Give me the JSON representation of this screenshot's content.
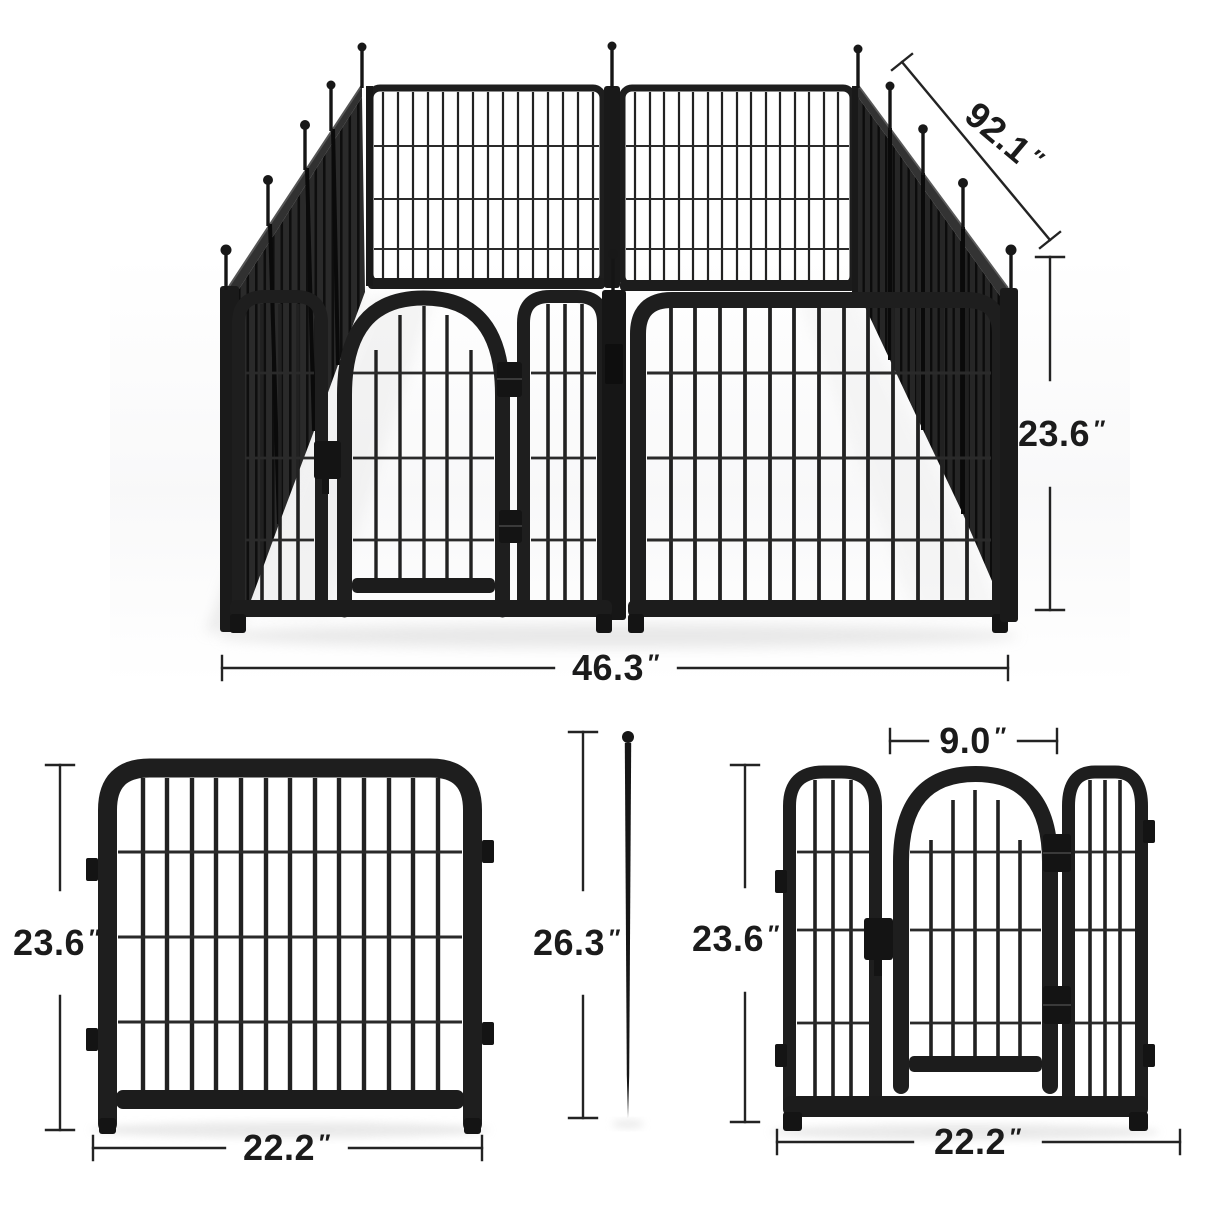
{
  "product": {
    "name": "Metal dog playpen dimension diagram",
    "views_count": "4"
  },
  "views": {
    "assembled_3d": {
      "name": "assembled-playpen-3d-view",
      "dims": {
        "depth": {
          "value": "92.1",
          "unit": "″"
        },
        "height": {
          "value": "23.6",
          "unit": "″"
        },
        "width": {
          "value": "46.3",
          "unit": "″"
        }
      }
    },
    "single_panel": {
      "name": "single-panel-front-view",
      "dims": {
        "height": {
          "value": "23.6",
          "unit": "″"
        },
        "width": {
          "value": "22.2",
          "unit": "″"
        }
      }
    },
    "ground_stake": {
      "name": "ground-stake-view",
      "dims": {
        "length": {
          "value": "26.3",
          "unit": "″"
        }
      }
    },
    "door_panel": {
      "name": "door-panel-front-view",
      "dims": {
        "door_width": {
          "value": "9.0",
          "unit": "″"
        },
        "height": {
          "value": "23.6",
          "unit": "″"
        },
        "width": {
          "value": "22.2",
          "unit": "″"
        }
      }
    }
  },
  "colors": {
    "metal_dark": "#1c1c1c",
    "metal_mid": "#2a2a2a",
    "dim_line": "#232323",
    "label_text": "#1b1b1b",
    "background": "#ffffff",
    "floor_shadow": "#dcdcdc"
  }
}
